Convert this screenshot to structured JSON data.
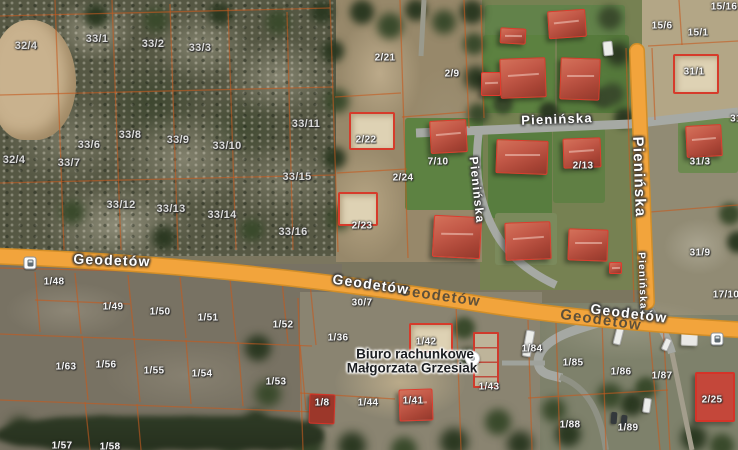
{
  "app": {
    "name": "satellite-map-view",
    "view_type": "satellite"
  },
  "map": {
    "streets": [
      "Geodetów",
      "Pienińska"
    ],
    "street_labels": [
      {
        "t": "Geodetów",
        "x": 112,
        "y": 260,
        "rot": 2,
        "size": 14
      },
      {
        "t": "Geodetów",
        "x": 440,
        "y": 296,
        "rot": 8,
        "size": 15,
        "ghost": true
      },
      {
        "t": "Geodetów",
        "x": 371,
        "y": 284,
        "rot": 8,
        "size": 14
      },
      {
        "t": "Geodetów",
        "x": 601,
        "y": 320,
        "rot": 8,
        "size": 15,
        "ghost": true
      },
      {
        "t": "Geodetów",
        "x": 629,
        "y": 313,
        "rot": 7,
        "size": 14
      },
      {
        "t": "Pienińska",
        "x": 557,
        "y": 119,
        "rot": -2,
        "size": 13
      },
      {
        "t": "Pienińska",
        "x": 477,
        "y": 190,
        "rot": 84,
        "size": 12
      },
      {
        "t": "Pienińska",
        "x": 639,
        "y": 177,
        "rot": 88,
        "size": 15
      },
      {
        "t": "Pienińska",
        "x": 642,
        "y": 281,
        "rot": 88,
        "size": 10
      }
    ],
    "parcel_labels": [
      {
        "t": "32/4",
        "x": 26,
        "y": 46,
        "big": true
      },
      {
        "t": "33/1",
        "x": 97,
        "y": 39,
        "big": true
      },
      {
        "t": "33/2",
        "x": 153,
        "y": 44,
        "big": true
      },
      {
        "t": "33/3",
        "x": 200,
        "y": 48,
        "big": true
      },
      {
        "t": "33/6",
        "x": 89,
        "y": 145,
        "big": true
      },
      {
        "t": "33/8",
        "x": 130,
        "y": 135,
        "big": true
      },
      {
        "t": "33/9",
        "x": 178,
        "y": 140,
        "big": true
      },
      {
        "t": "33/10",
        "x": 227,
        "y": 146,
        "big": true
      },
      {
        "t": "33/7",
        "x": 69,
        "y": 163,
        "big": true
      },
      {
        "t": "32/4",
        "x": 14,
        "y": 160,
        "big": true
      },
      {
        "t": "33/11",
        "x": 306,
        "y": 124,
        "big": true
      },
      {
        "t": "33/12",
        "x": 121,
        "y": 205,
        "big": true
      },
      {
        "t": "33/13",
        "x": 171,
        "y": 209,
        "big": true
      },
      {
        "t": "33/14",
        "x": 222,
        "y": 215,
        "big": true
      },
      {
        "t": "33/15",
        "x": 297,
        "y": 177,
        "big": true
      },
      {
        "t": "33/16",
        "x": 293,
        "y": 232,
        "big": true
      },
      {
        "t": "2/21",
        "x": 385,
        "y": 58
      },
      {
        "t": "2/9",
        "x": 452,
        "y": 74
      },
      {
        "t": "2/22",
        "x": 366,
        "y": 140
      },
      {
        "t": "2/24",
        "x": 403,
        "y": 178
      },
      {
        "t": "2/23",
        "x": 362,
        "y": 226
      },
      {
        "t": "7/10",
        "x": 438,
        "y": 162
      },
      {
        "t": "2/13",
        "x": 583,
        "y": 166
      },
      {
        "t": "15/16",
        "x": 724,
        "y": 7
      },
      {
        "t": "15/6",
        "x": 662,
        "y": 26
      },
      {
        "t": "15/1",
        "x": 698,
        "y": 33
      },
      {
        "t": "31/1",
        "x": 694,
        "y": 72
      },
      {
        "t": "31",
        "x": 736,
        "y": 119
      },
      {
        "t": "31/3",
        "x": 700,
        "y": 162
      },
      {
        "t": "31/9",
        "x": 700,
        "y": 253
      },
      {
        "t": "17/10",
        "x": 726,
        "y": 295
      },
      {
        "t": "30/7",
        "x": 362,
        "y": 303
      },
      {
        "t": "1/36",
        "x": 338,
        "y": 338
      },
      {
        "t": "1/42",
        "x": 426,
        "y": 342
      },
      {
        "t": "1/43",
        "x": 489,
        "y": 387
      },
      {
        "t": "1/8",
        "x": 322,
        "y": 403
      },
      {
        "t": "1/44",
        "x": 368,
        "y": 403
      },
      {
        "t": "1/41",
        "x": 413,
        "y": 401
      },
      {
        "t": "1/84",
        "x": 532,
        "y": 349
      },
      {
        "t": "1/85",
        "x": 573,
        "y": 363
      },
      {
        "t": "1/86",
        "x": 621,
        "y": 372
      },
      {
        "t": "1/87",
        "x": 662,
        "y": 376
      },
      {
        "t": "1/88",
        "x": 570,
        "y": 425
      },
      {
        "t": "1/89",
        "x": 628,
        "y": 428
      },
      {
        "t": "2/25",
        "x": 712,
        "y": 400
      },
      {
        "t": "1/48",
        "x": 54,
        "y": 282
      },
      {
        "t": "1/49",
        "x": 113,
        "y": 307
      },
      {
        "t": "1/50",
        "x": 160,
        "y": 312
      },
      {
        "t": "1/51",
        "x": 208,
        "y": 318
      },
      {
        "t": "1/52",
        "x": 283,
        "y": 325
      },
      {
        "t": "1/63",
        "x": 66,
        "y": 367
      },
      {
        "t": "1/56",
        "x": 106,
        "y": 365
      },
      {
        "t": "1/55",
        "x": 154,
        "y": 371
      },
      {
        "t": "1/54",
        "x": 202,
        "y": 374
      },
      {
        "t": "1/53",
        "x": 276,
        "y": 382
      },
      {
        "t": "1/57",
        "x": 62,
        "y": 446
      },
      {
        "t": "1/58",
        "x": 110,
        "y": 447
      }
    ],
    "poi": {
      "line1": "Biuro rachunkowe",
      "line2": "Małgorzata Grzesiak",
      "x": 472,
      "y": 358
    },
    "transit_stops": [
      {
        "x": 30,
        "y": 263
      },
      {
        "x": 717,
        "y": 339
      }
    ],
    "colors": {
      "road_orange": "#F2A43C",
      "road_grey": "#A6A9A4",
      "cadastral_line": "#C55A1F",
      "building_outline": "#D63B2B",
      "roof_red": "#B34A36",
      "lawn_green": "#5C8140",
      "label_text": "#FFFFFF",
      "poi_text": "#1C1E21"
    }
  }
}
